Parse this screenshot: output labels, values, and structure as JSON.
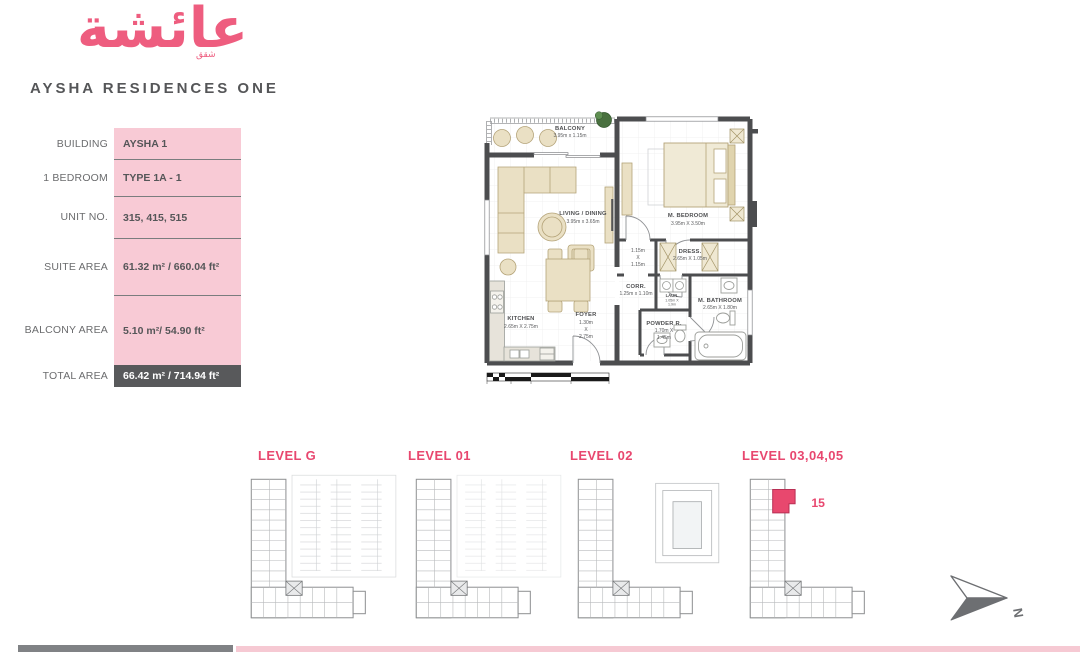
{
  "brand": {
    "arabic": "عائشة",
    "arabic_small": "شقق",
    "title": "AYSHA RESIDENCES ONE"
  },
  "details": {
    "rows": [
      {
        "label": "BUILDING",
        "value": "AYSHA 1"
      },
      {
        "label": "1 BEDROOM",
        "value": "TYPE 1A - 1"
      },
      {
        "label": "UNIT NO.",
        "value": "315, 415, 515"
      },
      {
        "label": "SUITE AREA",
        "value": "61.32 m² / 660.04  ft²"
      },
      {
        "label": "BALCONY AREA",
        "value": "5.10 m²/ 54.90 ft²"
      },
      {
        "label": "TOTAL AREA",
        "value": "66.42 m² / 714.94  ft²"
      }
    ]
  },
  "plan": {
    "balcony": {
      "name": "BALCONY",
      "dims": "3.95m x 1.15m"
    },
    "living": {
      "name": "LIVING / DINING",
      "dims": "3.95m x 3.65m"
    },
    "bedroom": {
      "name": "M. BEDROOM",
      "dims": "3.95m X 3.50m"
    },
    "closet": {
      "l1": "1.15m",
      "l2": "X",
      "l3": "1.15m"
    },
    "dress": {
      "name": "DRESS.",
      "dims": "2.65m X 1.05m"
    },
    "corr": {
      "name": "CORR.",
      "dims": "1.25m x 1.10m"
    },
    "laun": {
      "name": "LAUN.",
      "d1": "1.05m X",
      "d2": "1.9m"
    },
    "bath": {
      "name": "M. BATHROOM",
      "dims": "2.65m X 1.80m"
    },
    "kitchen": {
      "name": "KITCHEN",
      "dims": "2.65m X 2.75m"
    },
    "foyer": {
      "name": "FOYER",
      "d1": "1.30m",
      "d2": "X",
      "d3": "2.75m"
    },
    "powder": {
      "name": "POWDER R.",
      "d1": "1.70m X",
      "d2": "1.45m"
    }
  },
  "levels": [
    {
      "label": "LEVEL G"
    },
    {
      "label": "LEVEL 01"
    },
    {
      "label": "LEVEL 02"
    },
    {
      "label": "LEVEL 03,04,05",
      "unit": "15"
    }
  ],
  "compass": {
    "label": "N"
  },
  "colors": {
    "brand_pink": "#ee5d7f",
    "table_pink": "#f8cad5",
    "level_title_pink": "#e8476f",
    "highlight_unit": "#e8486e",
    "total_row_bg": "#58595b",
    "wall": "#4c4d4f",
    "furniture": "#eae0c4"
  }
}
